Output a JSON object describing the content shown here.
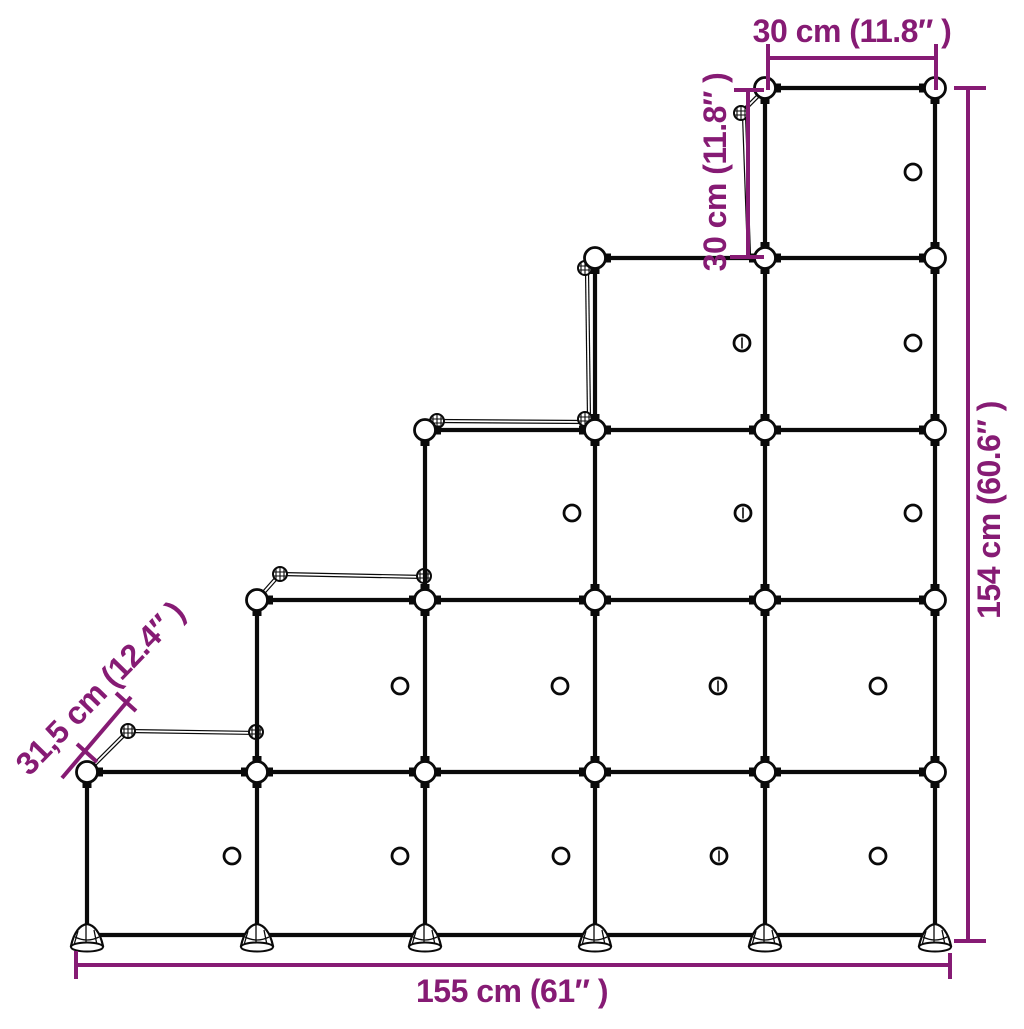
{
  "dimension_labels": {
    "cube_width": "30 cm (11.8″ )",
    "cube_height": "30 cm (11.8″ )",
    "total_height": "154 cm (60.6″ )",
    "depth": "31,5 cm (12.4″ )",
    "total_width": "155 cm (61″ )"
  },
  "colors": {
    "dimension": "#861B74",
    "line": "#0a0a0a",
    "background": "#ffffff"
  },
  "structure": {
    "columns": 5,
    "rows": 5,
    "cubes_per_column": [
      1,
      2,
      3,
      4,
      5
    ],
    "total_cubes": 15
  }
}
